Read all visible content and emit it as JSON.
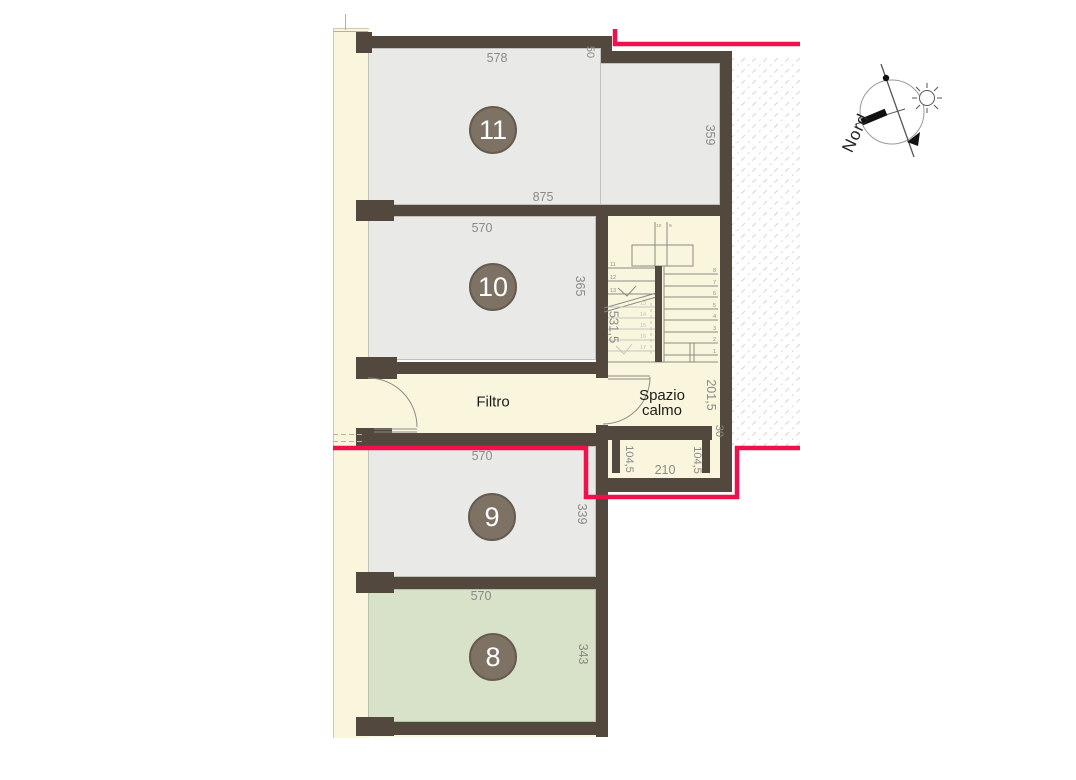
{
  "plan": {
    "corridor_label": "Filtro",
    "calm_space_label": "Spazio calmo",
    "compass_label": "Nord",
    "rooms": [
      {
        "number": "11",
        "top_dim": "578",
        "notch_dim": "50",
        "right_dim": "359",
        "bottom_dim": "875"
      },
      {
        "number": "10",
        "top_dim": "570",
        "right_dim": "365"
      },
      {
        "number": "9",
        "top_dim": "570",
        "right_dim": "339"
      },
      {
        "number": "8",
        "top_dim": "570",
        "right_dim": "343"
      }
    ],
    "stair": {
      "flight_length_dim": "531,5",
      "top_step_labels": [
        "10",
        "9"
      ],
      "upper_step_numbers": [
        "11",
        "12",
        "13"
      ],
      "lower_step_numbers": [
        "13",
        "14",
        "15",
        "16",
        "17"
      ],
      "right_step_numbers": [
        "8",
        "7",
        "6",
        "5",
        "4",
        "3",
        "2",
        "1"
      ]
    },
    "exit": {
      "calm_space_depth_dim": "201,5",
      "wall_thickness_dim": "30",
      "left_jamb_dim": "104,5",
      "door_width_dim": "210",
      "right_jamb_dim": "104,5"
    },
    "colors": {
      "cream": "#faf6dd",
      "room_gray": "#e9e9e8",
      "room_green": "#d7e2c8",
      "wall": "#53483d",
      "escape_route_red": "#f0104c",
      "badge_fill": "#7d7264"
    }
  }
}
